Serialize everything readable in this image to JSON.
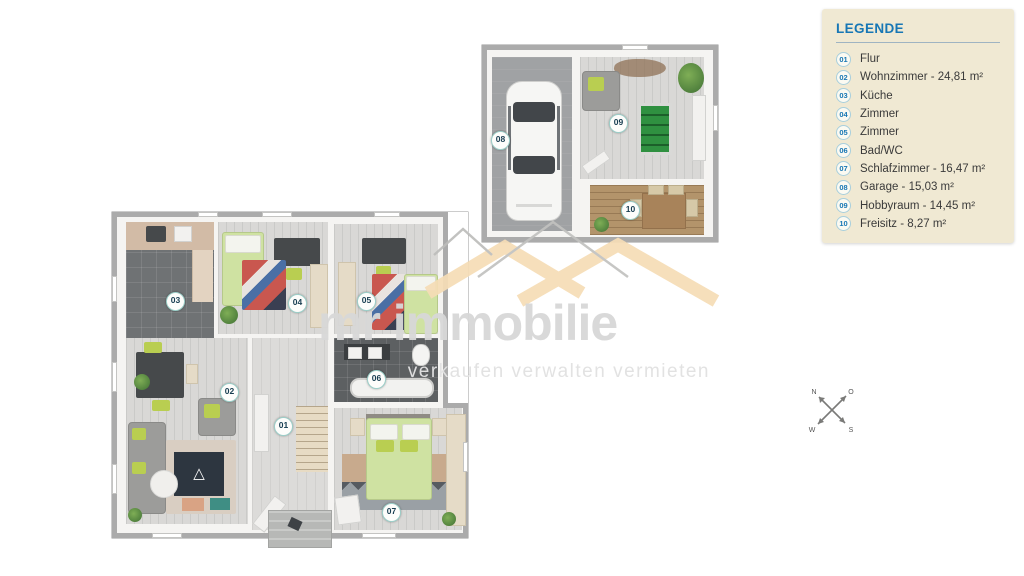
{
  "legend": {
    "title": "LEGENDE",
    "items": [
      {
        "num": "01",
        "label": "Flur"
      },
      {
        "num": "02",
        "label": "Wohnzimmer - 24,81 m²"
      },
      {
        "num": "03",
        "label": "Küche"
      },
      {
        "num": "04",
        "label": "Zimmer"
      },
      {
        "num": "05",
        "label": "Zimmer"
      },
      {
        "num": "06",
        "label": "Bad/WC"
      },
      {
        "num": "07",
        "label": "Schlafzimmer - 16,47 m²"
      },
      {
        "num": "08",
        "label": "Garage - 15,03 m²"
      },
      {
        "num": "09",
        "label": "Hobbyraum - 14,45 m²"
      },
      {
        "num": "10",
        "label": "Freisitz - 8,27 m²"
      }
    ]
  },
  "watermark": {
    "brand": "mr immobilie",
    "tagline": "verkaufen verwalten vermieten"
  },
  "floorplan": {
    "badges": {
      "b01": "01",
      "b02": "02",
      "b03": "03",
      "b04": "04",
      "b05": "05",
      "b06": "06",
      "b07": "07",
      "b08": "08",
      "b09": "09",
      "b10": "10"
    }
  },
  "compass": {
    "n": "N",
    "o": "O",
    "s": "S",
    "w": "W"
  },
  "colors": {
    "legend_bg": "#f0e9d3",
    "legend_title_blue": "#1777b5",
    "badge_ring_teal": "#9ccfc9",
    "watermark_gray": "#d8d8d8",
    "roof_beige": "#f6ddb6",
    "bed_green": "#cfe2a2",
    "accent_green": "#b9ce51",
    "floor_light": "#d9d8d6",
    "tile_dark": "#5d6062",
    "deck_wood": "#b3946b"
  }
}
